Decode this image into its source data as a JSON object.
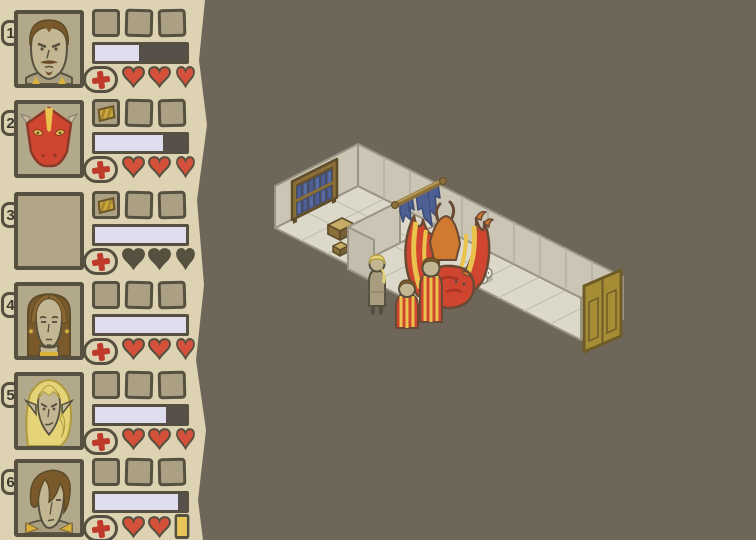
{
  "app": {
    "name": "hand-drawn dungeon crawler",
    "view": "party and isometric dungeon"
  },
  "colors": {
    "background": "#6e6759",
    "sidebar": "#ddd3b3",
    "outline_ink": "#55503f",
    "slot": "#aba083",
    "portrait_bg": "#b2a88a",
    "bar_track": "#57504a",
    "bar_fill": "#dfdded",
    "heart_red": "#d5503a",
    "cross_red": "#bf3a2b",
    "gold_token": "#e8c558",
    "wall": "#cac5b5",
    "floor": "#dcd9cb",
    "curtain_blue": "#4d5f93",
    "dragon_red": "#d0452f",
    "dragon_yellow": "#e9c34b",
    "door_gold": "#a58c35"
  },
  "party": {
    "members": [
      {
        "number": "1",
        "portrait": "stern-man",
        "slots": [
          "empty",
          "empty",
          "empty"
        ],
        "hp_percent": 48,
        "hearts": [
          "full",
          "full",
          "full"
        ]
      },
      {
        "number": "2",
        "portrait": "red-dragon",
        "slots": [
          "loot",
          "empty",
          "empty"
        ],
        "hp_percent": 75,
        "hearts": [
          "full",
          "full",
          "full"
        ]
      },
      {
        "number": "3",
        "portrait": "empty",
        "slots": [
          "loot",
          "empty",
          "empty"
        ],
        "hp_percent": 100,
        "hearts": [
          "empty",
          "empty",
          "empty"
        ]
      },
      {
        "number": "4",
        "portrait": "brown-haired-woman",
        "slots": [
          "empty",
          "empty",
          "empty"
        ],
        "hp_percent": 100,
        "hearts": [
          "full",
          "full",
          "full"
        ]
      },
      {
        "number": "5",
        "portrait": "blonde-elf",
        "slots": [
          "empty",
          "empty",
          "empty"
        ],
        "hp_percent": 78,
        "hearts": [
          "full",
          "full",
          "full"
        ]
      },
      {
        "number": "6",
        "portrait": "young-man",
        "slots": [
          "empty",
          "empty",
          "empty"
        ],
        "hp_percent": 91,
        "hearts": [
          "full",
          "full",
          "gold"
        ]
      }
    ]
  },
  "scene": {
    "rooms": [
      "library-room",
      "dragon-lair",
      "corridor"
    ],
    "objects": [
      "bookshelf-with-blue-books",
      "torn-blue-curtain-on-rod",
      "wooden-bench",
      "small-crate",
      "skull-and-bones",
      "pile-of-skulls",
      "red-dragon-with-spread-wings",
      "blonde-adventurer",
      "striped-robe-figure",
      "striped-robe-figure",
      "double-wooden-door"
    ]
  }
}
